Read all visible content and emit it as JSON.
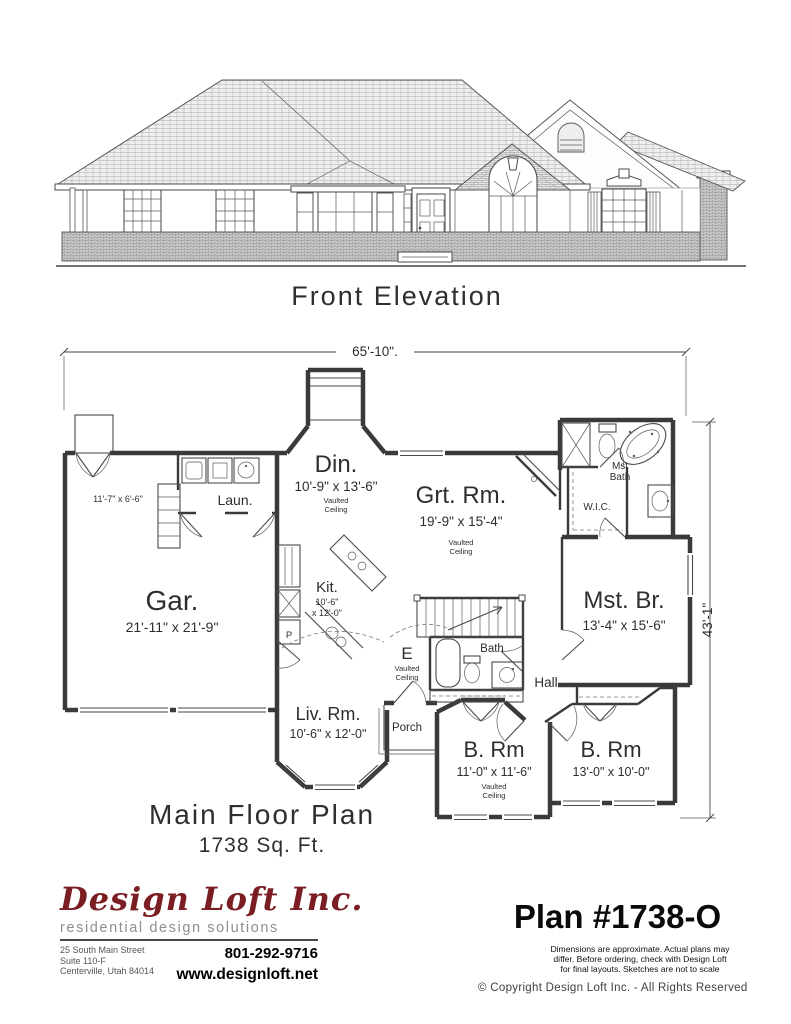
{
  "colors": {
    "logo_red": "#7a1e23",
    "ink": "#2e2e2e",
    "tagline_gray": "#8f8f8f"
  },
  "elevation": {
    "title": "Front Elevation"
  },
  "plan": {
    "title": "Main Floor Plan",
    "area": "1738 Sq. Ft.",
    "dim_width": "65'-10\".",
    "dim_height": "43'-1\"",
    "garage": {
      "label": "Gar.",
      "dims": "21'-11\" x 21'-9\""
    },
    "storage": {
      "dims": "11'-7\" x 6'-6\""
    },
    "laundry": {
      "label": "Laun."
    },
    "dining": {
      "label": "Din.",
      "dims": "10'-9\" x 13'-6\"",
      "note1": "Vaulted",
      "note2": "Ceiling"
    },
    "great_room": {
      "label": "Grt. Rm.",
      "dims": "19'-9\" x 15'-4\"",
      "note1": "Vaulted",
      "note2": "Ceiling"
    },
    "kitchen": {
      "label": "Kit.",
      "dims1": "10'-6\"",
      "dims2": "x 12'-0\"",
      "pantry": "P"
    },
    "master_bath": {
      "line1": "Mst",
      "line2": "Bath"
    },
    "wic": {
      "label": "W.I.C."
    },
    "master_bedroom": {
      "label": "Mst. Br.",
      "dims": "13'-4\" x 15'-6\""
    },
    "entry": {
      "label": "E",
      "note1": "Vaulted",
      "note2": "Ceiling"
    },
    "bath": {
      "label": "Bath"
    },
    "hall": {
      "label": "Hall"
    },
    "living_room": {
      "label": "Liv. Rm.",
      "dims": "10'-6\" x 12'-0\""
    },
    "porch": {
      "label": "Porch"
    },
    "bedroom2": {
      "label": "B. Rm",
      "dims": "11'-0\" x 11'-6\"",
      "note1": "Vaulted",
      "note2": "Ceiling"
    },
    "bedroom3": {
      "label": "B. Rm",
      "dims": "13'-0\" x 10'-0\""
    }
  },
  "footer": {
    "company": "Design Loft Inc.",
    "tagline": "residential design solutions",
    "address1": "25 South Main Street",
    "address2": "Suite 110-F",
    "address3": "Centerville, Utah 84014",
    "phone": "801-292-9716",
    "website": "www.designloft.net",
    "plan_number": "Plan #1738-O",
    "disclaimer1": "Dimensions are approximate.  Actual plans may",
    "disclaimer2": "differ.  Before ordering, check with Design Loft",
    "disclaimer3": "for final layouts.  Sketches are not to scale",
    "copyright": "© Copyright Design Loft Inc. - All Rights Reserved"
  }
}
